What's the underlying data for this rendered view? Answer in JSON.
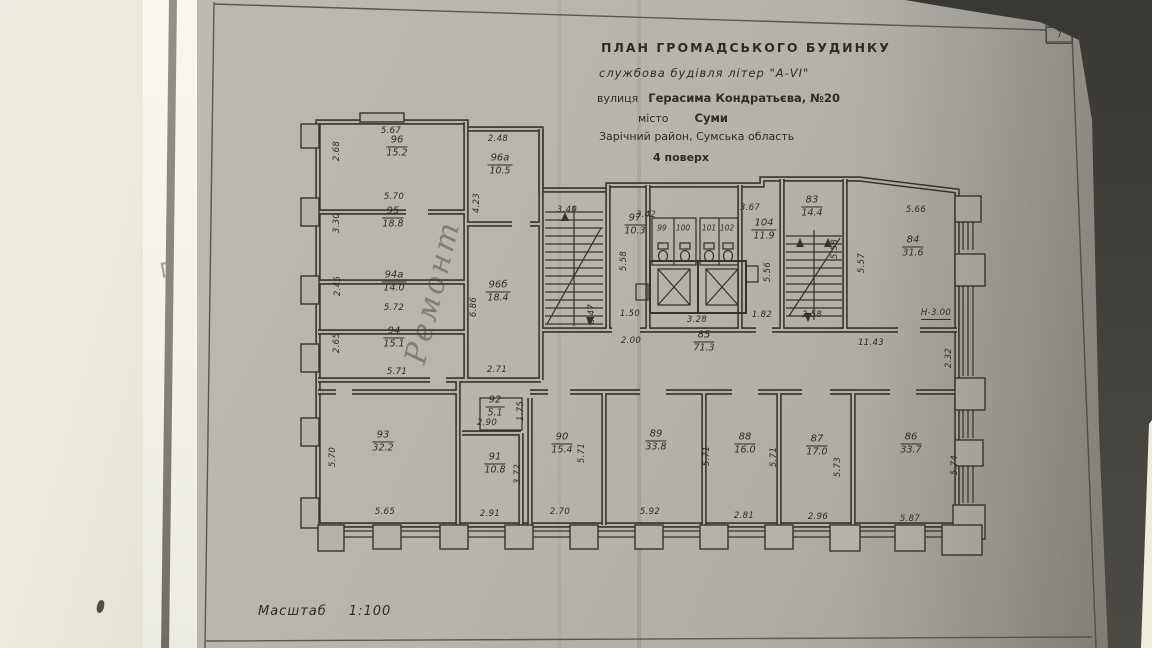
{
  "sheet": {
    "corner_tab": "7"
  },
  "title_block": {
    "line1": "ПЛАН  ГРОМАДСЬКОГО  БУДИНКУ",
    "line2": "службова будівля літер \"А-VI\"",
    "line3_prefix": "вулиця",
    "line3_value": "Герасима Кондратьєва, №20",
    "line4_prefix": "місто",
    "line4_value": "Суми",
    "line5": "Зарічний район, Сумська область",
    "line6": "4 поверх"
  },
  "scale": {
    "label": "Масштаб",
    "value": "1:100"
  },
  "handwritten_note": "Ремонт",
  "plan": {
    "rooms": [
      {
        "number": "96",
        "area": "15.2",
        "x": 397,
        "y": 147
      },
      {
        "number": "96а",
        "area": "10.5",
        "x": 500,
        "y": 165
      },
      {
        "number": "95",
        "area": "18.8",
        "x": 393,
        "y": 218
      },
      {
        "number": "94а",
        "area": "14.0",
        "x": 394,
        "y": 282
      },
      {
        "number": "94",
        "area": "15.1",
        "x": 394,
        "y": 338
      },
      {
        "number": "96б",
        "area": "18.4",
        "x": 498,
        "y": 292
      },
      {
        "number": "97",
        "area": "10.3",
        "x": 635,
        "y": 225
      },
      {
        "number": "104",
        "area": "11.9",
        "x": 764,
        "y": 230
      },
      {
        "number": "83",
        "area": "14.4",
        "x": 812,
        "y": 207
      },
      {
        "number": "84",
        "area": "31.6",
        "x": 913,
        "y": 247
      },
      {
        "number": "85",
        "area": "71.3",
        "x": 704,
        "y": 342
      },
      {
        "number": "92",
        "area": "5.1",
        "x": 495,
        "y": 407
      },
      {
        "number": "93",
        "area": "32.2",
        "x": 383,
        "y": 442
      },
      {
        "number": "91",
        "area": "10.8",
        "x": 495,
        "y": 464
      },
      {
        "number": "90",
        "area": "15.4",
        "x": 562,
        "y": 444
      },
      {
        "number": "89",
        "area": "33.8",
        "x": 656,
        "y": 441
      },
      {
        "number": "88",
        "area": "16.0",
        "x": 745,
        "y": 444
      },
      {
        "number": "87",
        "area": "17.0",
        "x": 817,
        "y": 446
      },
      {
        "number": "86",
        "area": "33.7",
        "x": 911,
        "y": 444
      }
    ],
    "wc_rooms": [
      {
        "number": "99",
        "x": 662,
        "y": 228
      },
      {
        "number": "100",
        "x": 683,
        "y": 228
      },
      {
        "number": "101",
        "x": 709,
        "y": 228
      },
      {
        "number": "102",
        "x": 727,
        "y": 228
      }
    ],
    "dimensions": [
      {
        "t": "5.67",
        "x": 391,
        "y": 131
      },
      {
        "t": "2.48",
        "x": 498,
        "y": 139
      },
      {
        "t": "2.68",
        "x": 337,
        "y": 151,
        "v": 1
      },
      {
        "t": "5.70",
        "x": 394,
        "y": 197
      },
      {
        "t": "3.30",
        "x": 337,
        "y": 223,
        "v": 1
      },
      {
        "t": "2.45",
        "x": 338,
        "y": 286,
        "v": 1
      },
      {
        "t": "5.72",
        "x": 394,
        "y": 308
      },
      {
        "t": "2.65",
        "x": 337,
        "y": 343,
        "v": 1
      },
      {
        "t": "5.71",
        "x": 397,
        "y": 372
      },
      {
        "t": "4.23",
        "x": 477,
        "y": 203,
        "v": 1
      },
      {
        "t": "6.86",
        "x": 474,
        "y": 307,
        "v": 1
      },
      {
        "t": "2.71",
        "x": 497,
        "y": 370
      },
      {
        "t": "3.40",
        "x": 567,
        "y": 210
      },
      {
        "t": "3.42",
        "x": 646,
        "y": 215
      },
      {
        "t": "3.67",
        "x": 750,
        "y": 208
      },
      {
        "t": "5.66",
        "x": 916,
        "y": 210
      },
      {
        "t": "5.58",
        "x": 624,
        "y": 261,
        "v": 1
      },
      {
        "t": "8.47",
        "x": 592,
        "y": 314,
        "v": 1
      },
      {
        "t": "1.50",
        "x": 630,
        "y": 314
      },
      {
        "t": "2.00",
        "x": 631,
        "y": 341
      },
      {
        "t": "3.28",
        "x": 697,
        "y": 320
      },
      {
        "t": "5.56",
        "x": 768,
        "y": 272,
        "v": 1
      },
      {
        "t": "1.82",
        "x": 762,
        "y": 315
      },
      {
        "t": "2.58",
        "x": 812,
        "y": 315
      },
      {
        "t": "5.58",
        "x": 835,
        "y": 249,
        "v": 1
      },
      {
        "t": "5.57",
        "x": 862,
        "y": 263,
        "v": 1
      },
      {
        "t": "11.43",
        "x": 871,
        "y": 343
      },
      {
        "t": "H-3.00",
        "x": 936,
        "y": 314,
        "u": 1
      },
      {
        "t": "2.32",
        "x": 949,
        "y": 358,
        "v": 1
      },
      {
        "t": "2.90",
        "x": 487,
        "y": 423
      },
      {
        "t": "1.75",
        "x": 521,
        "y": 411,
        "v": 1
      },
      {
        "t": "3.72",
        "x": 518,
        "y": 474,
        "v": 1
      },
      {
        "t": "5.70",
        "x": 333,
        "y": 457,
        "v": 1
      },
      {
        "t": "5.65",
        "x": 385,
        "y": 512
      },
      {
        "t": "2.91",
        "x": 490,
        "y": 514
      },
      {
        "t": "2.70",
        "x": 560,
        "y": 512
      },
      {
        "t": "5.71",
        "x": 582,
        "y": 453,
        "v": 1
      },
      {
        "t": "5.92",
        "x": 650,
        "y": 512
      },
      {
        "t": "5.71",
        "x": 707,
        "y": 456,
        "v": 1
      },
      {
        "t": "2.81",
        "x": 744,
        "y": 516
      },
      {
        "t": "5.71",
        "x": 774,
        "y": 457,
        "v": 1
      },
      {
        "t": "2.96",
        "x": 818,
        "y": 517
      },
      {
        "t": "5.73",
        "x": 838,
        "y": 467,
        "v": 1
      },
      {
        "t": "5.87",
        "x": 910,
        "y": 519
      },
      {
        "t": "5.74",
        "x": 955,
        "y": 465,
        "v": 1
      }
    ]
  }
}
